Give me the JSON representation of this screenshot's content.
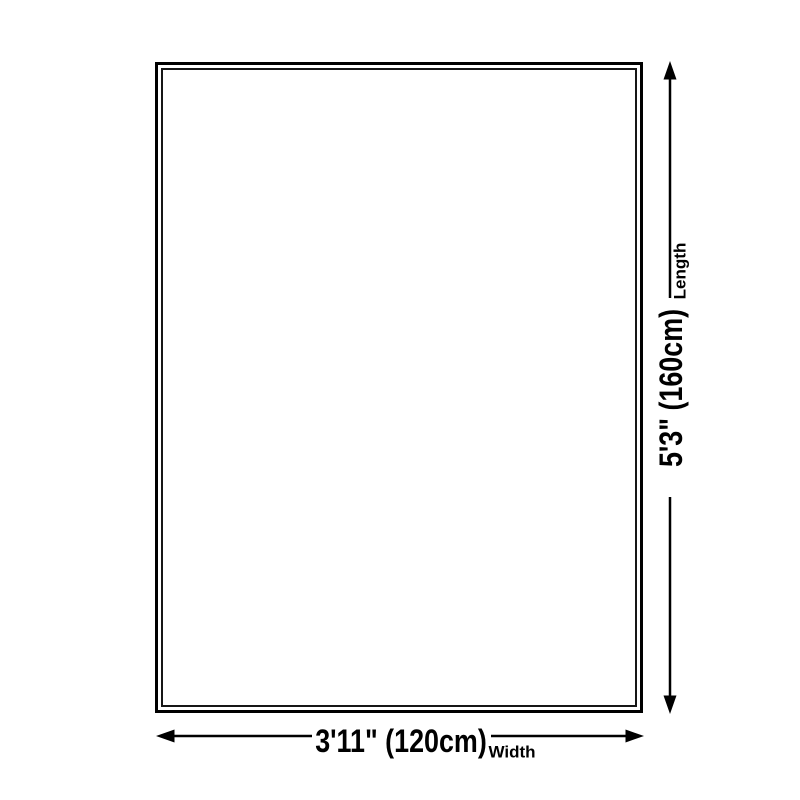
{
  "figure": {
    "length": {
      "label": "Length",
      "value": "5'3\" (160cm)"
    },
    "width": {
      "label": "Width",
      "value": "3'11\" (120cm)"
    }
  },
  "colors": {
    "ink": "#000000",
    "background": "#ffffff"
  }
}
